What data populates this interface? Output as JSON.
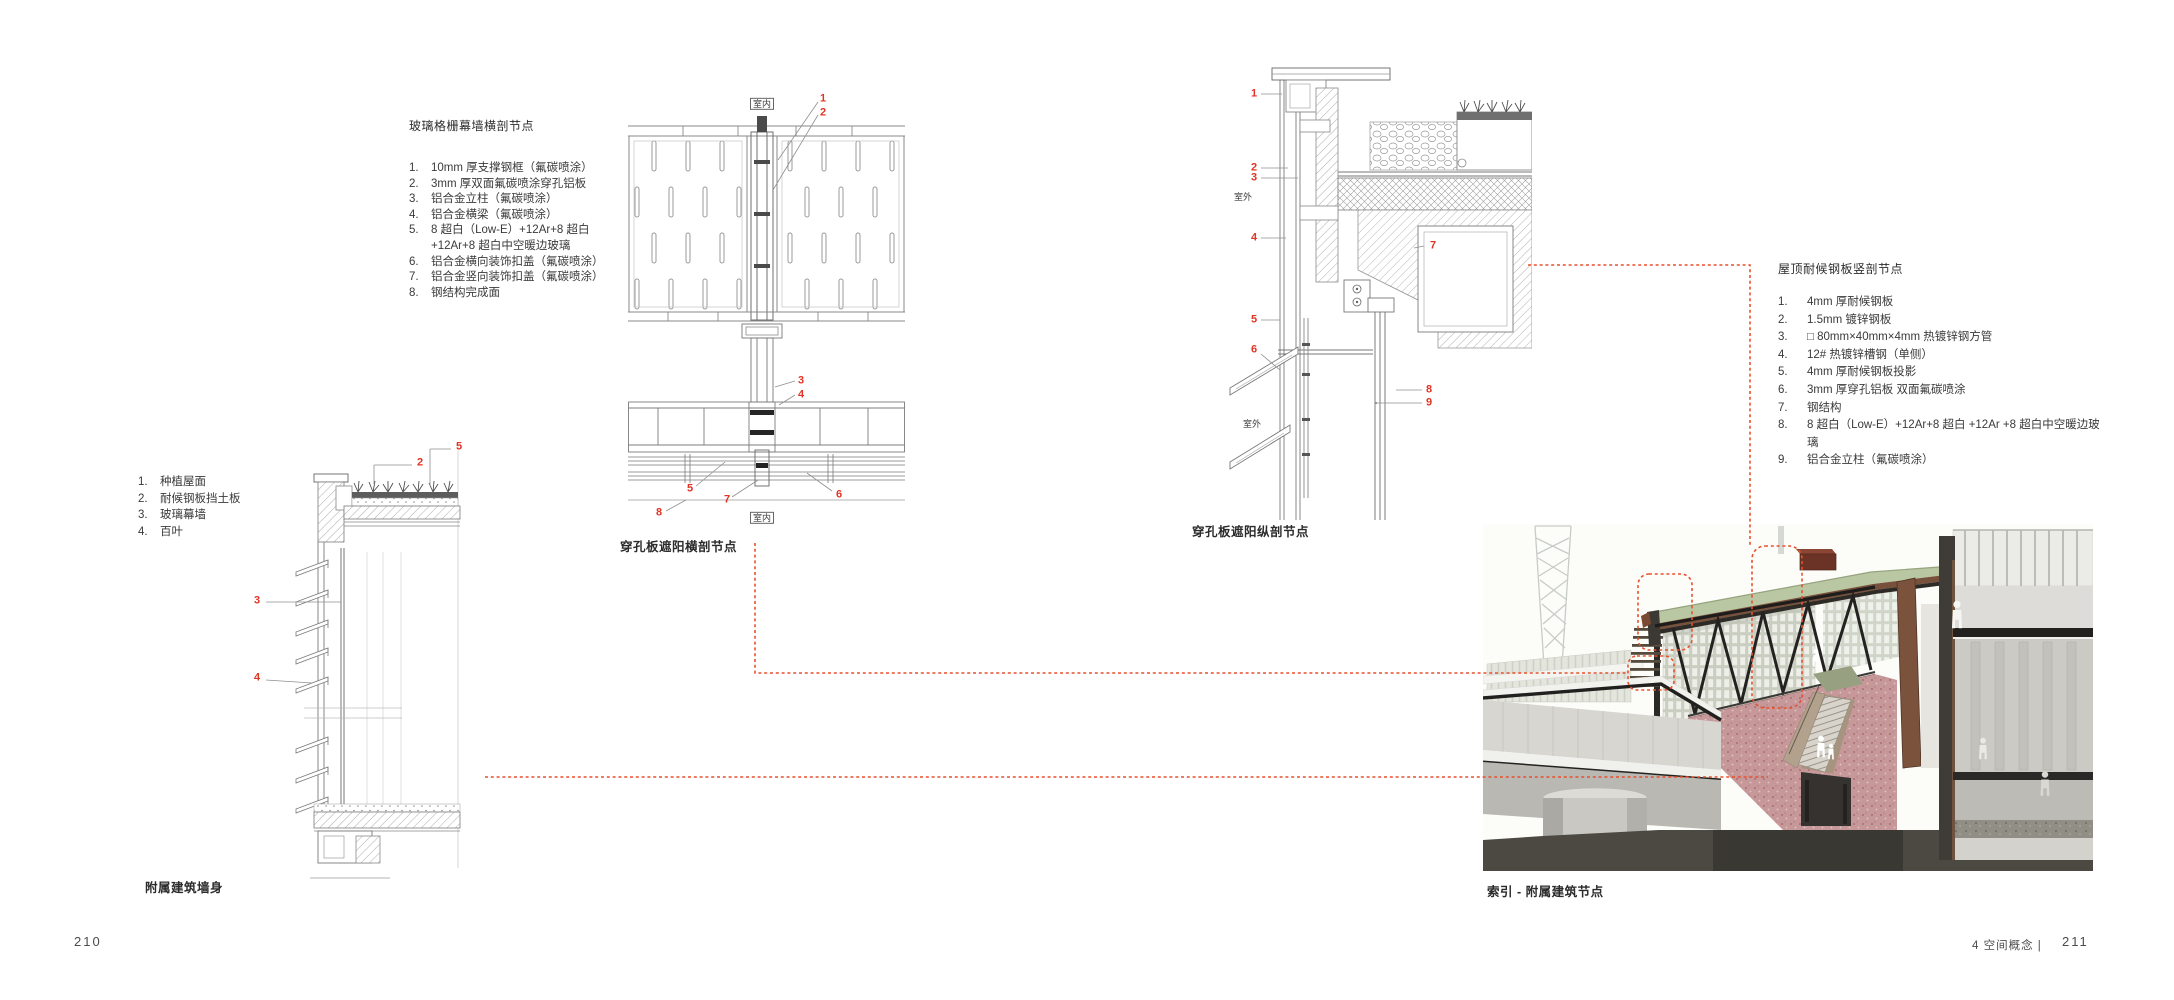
{
  "legend_glass_curtain": {
    "title": "玻璃格栅幕墙横剖节点",
    "items": [
      "10mm 厚支撑钢框（氟碳喷涂）",
      "3mm 厚双面氟碳喷涂穿孔铝板",
      "铝合金立柱（氟碳喷涂）",
      "铝合金横梁（氟碳喷涂）",
      "8 超白（Low-E）+12Ar+8 超白 +12Ar+8 超白中空暖边玻璃",
      "铝合金横向装饰扣盖（氟碳喷涂）",
      "铝合金竖向装饰扣盖（氟碳喷涂）",
      "钢结构完成面"
    ]
  },
  "legend_annex": {
    "items": [
      "种植屋面",
      "耐候钢板挡土板",
      "玻璃幕墙",
      "百叶"
    ]
  },
  "legend_roof_steel": {
    "title": "屋顶耐候钢板竖剖节点",
    "items": [
      "4mm 厚耐候钢板",
      "1.5mm 镀锌钢板",
      "□ 80mm×40mm×4mm 热镀锌钢方管",
      "12# 热镀锌槽钢（单侧）",
      "4mm 厚耐候钢板投影",
      "3mm 厚穿孔铝板 双面氟碳喷涂",
      "钢结构",
      "8 超白（Low-E）+12Ar+8 超白 +12Ar +8 超白中空暖边玻璃",
      "铝合金立柱（氟碳喷涂）"
    ]
  },
  "figures": {
    "center_detail": {
      "caption": "穿孔板遮阳横剖节点",
      "annotations": [
        {
          "t": "室内",
          "x": 762,
          "y": 104,
          "kind": "label",
          "boxed": true
        },
        {
          "t": "1",
          "x": 823,
          "y": 99,
          "kind": "num"
        },
        {
          "t": "2",
          "x": 823,
          "y": 113,
          "kind": "num"
        },
        {
          "t": "3",
          "x": 801,
          "y": 381,
          "kind": "num"
        },
        {
          "t": "4",
          "x": 801,
          "y": 395,
          "kind": "num"
        },
        {
          "t": "5",
          "x": 690,
          "y": 489,
          "kind": "num"
        },
        {
          "t": "7",
          "x": 727,
          "y": 500,
          "kind": "num"
        },
        {
          "t": "8",
          "x": 659,
          "y": 513,
          "kind": "num"
        },
        {
          "t": "6",
          "x": 839,
          "y": 495,
          "kind": "num"
        },
        {
          "t": "室内",
          "x": 762,
          "y": 518,
          "kind": "label",
          "boxed": true
        }
      ]
    },
    "right_detail": {
      "caption": "穿孔板遮阳纵剖节点",
      "annotations": [
        {
          "t": "1",
          "x": 1254,
          "y": 94,
          "kind": "num"
        },
        {
          "t": "2",
          "x": 1254,
          "y": 168,
          "kind": "num"
        },
        {
          "t": "3",
          "x": 1254,
          "y": 178,
          "kind": "num"
        },
        {
          "t": "室外",
          "x": 1243,
          "y": 197,
          "kind": "label"
        },
        {
          "t": "4",
          "x": 1254,
          "y": 238,
          "kind": "num"
        },
        {
          "t": "7",
          "x": 1433,
          "y": 246,
          "kind": "num"
        },
        {
          "t": "5",
          "x": 1254,
          "y": 320,
          "kind": "num"
        },
        {
          "t": "6",
          "x": 1254,
          "y": 350,
          "kind": "num"
        },
        {
          "t": "8",
          "x": 1429,
          "y": 390,
          "kind": "num"
        },
        {
          "t": "9",
          "x": 1429,
          "y": 403,
          "kind": "num"
        },
        {
          "t": "室外",
          "x": 1252,
          "y": 424,
          "kind": "label"
        }
      ]
    },
    "left_detail": {
      "caption": "附属建筑墙身",
      "annotations": [
        {
          "t": "5",
          "x": 459,
          "y": 447,
          "kind": "num"
        },
        {
          "t": "2",
          "x": 420,
          "y": 463,
          "kind": "num"
        },
        {
          "t": "3",
          "x": 257,
          "y": 601,
          "kind": "num"
        },
        {
          "t": "4",
          "x": 257,
          "y": 678,
          "kind": "num"
        }
      ]
    },
    "render": {
      "caption": "索引 - 附属建筑节点"
    }
  },
  "footer": {
    "page_left": "210",
    "section": "4  空间概念 |",
    "page_right": "211"
  },
  "colors": {
    "callout_red": "#e03425",
    "leader_red": "#e8512f",
    "drawing_line": "#7a7a7a",
    "text": "#333333",
    "roof_green": "#b9c7a3",
    "floor_pink": "#c69899",
    "steel_dark": "#242220"
  }
}
